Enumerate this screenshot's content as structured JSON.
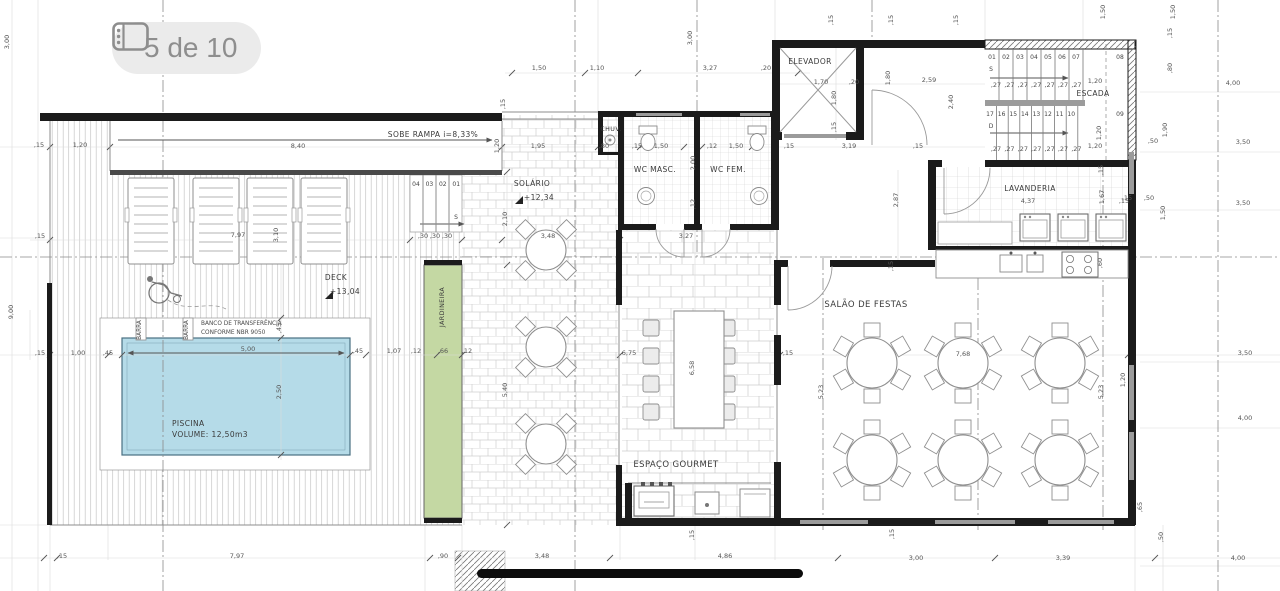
{
  "viewer": {
    "badge_label": "5 de 10"
  },
  "labels": {
    "rampa": "SOBE RAMPA i=8,33%",
    "solario": "SOLÁRIO",
    "solario_level": "+12,34",
    "chuv": "CHUV.",
    "wc_masc": "WC MASC.",
    "wc_fem": "WC FEM.",
    "elevador": "ELEVADOR",
    "escada": "ESCADA",
    "lavanderia": "LAVANDERIA",
    "salao": "SALÃO DE FESTAS",
    "gourmet": "ESPAÇO GOURMET",
    "deck": "DECK",
    "deck_level": "+13,04",
    "jardineira": "JARDINEIRA",
    "piscina": "PISCINA",
    "piscina_volume": "VOLUME: 12,50m3",
    "banco_1": "BANCO DE TRANSFERÊNCIA",
    "banco_2": "CONFORME NBR 9050",
    "barra": "BARRA",
    "sobe": "S",
    "desce": "D"
  },
  "stairs": {
    "upper_steps": [
      "01",
      "02",
      "03",
      "04",
      "05",
      "06",
      "07"
    ],
    "upper_landing": "08",
    "lower_steps": [
      "17",
      "16",
      "15",
      "14",
      "13",
      "12",
      "11",
      "10"
    ],
    "lower_landing": "09",
    "tread": ",27"
  },
  "deck_steps": {
    "numbers": [
      "04",
      "03",
      "02",
      "01"
    ]
  },
  "dimensions": [
    [
      "3,00",
      9,
      42,
      1
    ],
    [
      "9,00",
      13,
      312,
      1
    ],
    [
      ",15",
      39,
      147,
      0
    ],
    [
      "1,20",
      80,
      147,
      0
    ],
    [
      "8,40",
      298,
      148,
      0
    ],
    [
      "1,20",
      499,
      146,
      1
    ],
    [
      "1,95",
      538,
      148,
      0
    ],
    [
      ",15",
      40,
      238,
      0
    ],
    [
      ",15",
      40,
      355,
      0
    ],
    [
      "1,00",
      78,
      355,
      0
    ],
    [
      ",45",
      108,
      355,
      0
    ],
    [
      "7,97",
      238,
      237,
      0
    ],
    [
      "3,10",
      278,
      235,
      1
    ],
    [
      ",30",
      423,
      238,
      0
    ],
    [
      ",30",
      435,
      238,
      0
    ],
    [
      ",30",
      447,
      238,
      0
    ],
    [
      "5,00",
      248,
      351,
      0
    ],
    [
      ",45",
      358,
      353,
      0
    ],
    [
      "1,07",
      394,
      353,
      0
    ],
    [
      ",12",
      416,
      353,
      0
    ],
    [
      ",66",
      443,
      353,
      0
    ],
    [
      ",12",
      467,
      353,
      0
    ],
    [
      ",45",
      281,
      328,
      1
    ],
    [
      "2,50",
      281,
      392,
      1
    ],
    [
      "2,10",
      507,
      219,
      1
    ],
    [
      "3,48",
      548,
      238,
      0
    ],
    [
      "5,40",
      507,
      390,
      1
    ],
    [
      "1,50",
      539,
      70,
      0
    ],
    [
      "1,10",
      597,
      70,
      0
    ],
    [
      "3,00",
      692,
      38,
      1
    ],
    [
      "3,27",
      710,
      70,
      0
    ],
    [
      ",20",
      766,
      70,
      0
    ],
    [
      ",15",
      505,
      104,
      1
    ],
    [
      ",80",
      604,
      148,
      0
    ],
    [
      ",15",
      637,
      148,
      0
    ],
    [
      "1,50",
      661,
      148,
      0
    ],
    [
      ",12",
      712,
      148,
      0
    ],
    [
      "1,50",
      736,
      148,
      0
    ],
    [
      ",15",
      789,
      148,
      0
    ],
    [
      "2,00",
      695,
      163,
      1
    ],
    [
      ",12",
      695,
      204,
      1
    ],
    [
      "3,27",
      686,
      238,
      0
    ],
    [
      "6,75",
      629,
      355,
      0
    ],
    [
      "6,58",
      694,
      368,
      1
    ],
    [
      ",15",
      788,
      355,
      0
    ],
    [
      "1,70",
      821,
      84,
      0
    ],
    [
      ",20",
      854,
      84,
      0
    ],
    [
      "1,80",
      836,
      98,
      1
    ],
    [
      ",15",
      836,
      127,
      1
    ],
    [
      "1,80",
      890,
      78,
      1
    ],
    [
      "2,59",
      929,
      82,
      0
    ],
    [
      "2,40",
      953,
      102,
      1
    ],
    [
      "3,19",
      849,
      148,
      0
    ],
    [
      ",15",
      918,
      148,
      0
    ],
    [
      "2,87",
      898,
      200,
      1
    ],
    [
      ",15",
      893,
      266,
      1
    ],
    [
      ",15",
      833,
      20,
      1
    ],
    [
      ",15",
      893,
      20,
      1
    ],
    [
      ",15",
      958,
      20,
      1
    ],
    [
      "1,50",
      1105,
      12,
      1
    ],
    [
      "1,50",
      1175,
      12,
      1
    ],
    [
      ",15",
      1172,
      33,
      1
    ],
    [
      ",80",
      1172,
      68,
      1
    ],
    [
      "1,20",
      1095,
      83,
      0
    ],
    [
      "1,20",
      1101,
      133,
      1
    ],
    [
      "1,20",
      1095,
      148,
      0
    ],
    [
      "4,00",
      1233,
      85,
      0
    ],
    [
      "1,90",
      1167,
      130,
      1
    ],
    [
      ",50",
      1153,
      143,
      0
    ],
    [
      "3,50",
      1243,
      144,
      0
    ],
    [
      ",15",
      1127,
      200,
      0
    ],
    [
      ",50",
      1149,
      200,
      0
    ],
    [
      "3,50",
      1243,
      205,
      0
    ],
    [
      "1,50",
      1165,
      213,
      1
    ],
    [
      ",15",
      1103,
      170,
      1
    ],
    [
      "4,37",
      1028,
      203,
      0
    ],
    [
      "1,67",
      1104,
      197,
      1
    ],
    [
      ",15",
      1124,
      203,
      0
    ],
    [
      ",60",
      1102,
      263,
      1
    ],
    [
      "7,68",
      963,
      356,
      0
    ],
    [
      "5,23",
      823,
      392,
      1
    ],
    [
      "5,23",
      1103,
      392,
      1
    ],
    [
      "1,20",
      1125,
      380,
      1
    ],
    [
      "3,50",
      1245,
      355,
      0
    ],
    [
      "4,00",
      1245,
      420,
      0
    ],
    [
      ",65",
      1142,
      507,
      1
    ],
    [
      ",15",
      62,
      558,
      0
    ],
    [
      "7,97",
      237,
      558,
      0
    ],
    [
      ",90",
      443,
      558,
      0
    ],
    [
      "3,48",
      542,
      558,
      0
    ],
    [
      "4,86",
      725,
      558,
      0
    ],
    [
      "3,00",
      916,
      560,
      0
    ],
    [
      "3,39",
      1063,
      560,
      0
    ],
    [
      "4,00",
      1238,
      560,
      0
    ],
    [
      ",15",
      694,
      535,
      1
    ],
    [
      ",15",
      894,
      534,
      1
    ],
    [
      ",50",
      1163,
      537,
      1
    ]
  ],
  "colors": {
    "pool": "#b5dbe8",
    "pool_border": "#4a7082",
    "planter": "#c4d8a3",
    "wall": "#1b1b1b",
    "window": "#9b9b9b",
    "badge_bg": "#ebebeb",
    "badge_fg": "#8e8e8e",
    "scrollbar": "#0c0c0c"
  }
}
